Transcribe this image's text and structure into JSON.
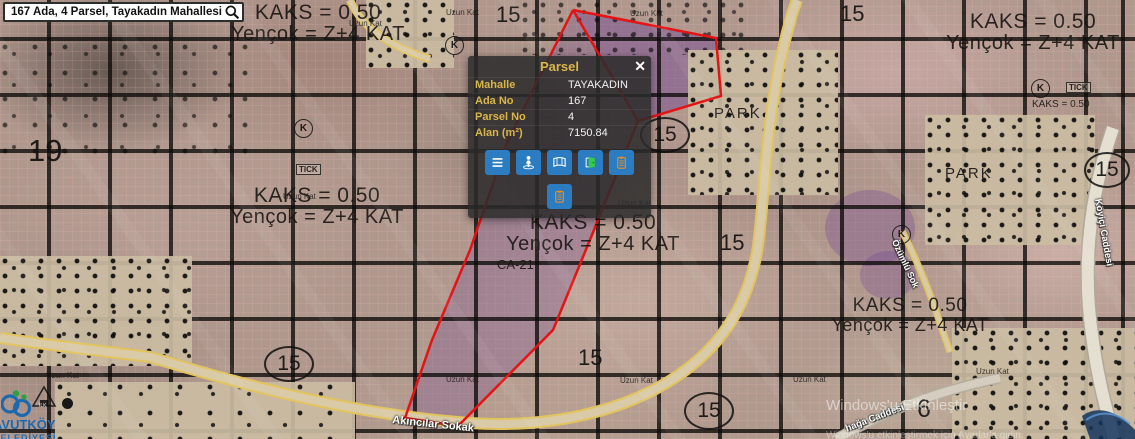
{
  "search": {
    "value": "167 Ada, 4 Parsel, Tayakadın Mahallesi",
    "icon": "magnifier-icon"
  },
  "popup": {
    "title": "Parsel",
    "close_label": "✕",
    "fields": [
      {
        "label": "Mahalle",
        "value": "TAYAKADIN"
      },
      {
        "label": "Ada No",
        "value": "167"
      },
      {
        "label": "Parsel No",
        "value": "4"
      },
      {
        "label": "Alan (m²)",
        "value": "7150.84"
      }
    ],
    "buttons": [
      {
        "icon": "menu-icon"
      },
      {
        "icon": "street-view-icon"
      },
      {
        "icon": "panorama-icon"
      },
      {
        "icon": "door-icon"
      },
      {
        "icon": "clipboard-icon"
      },
      {
        "icon": "clipboard-icon"
      }
    ],
    "colors": {
      "accent_gold": "#d9b64a",
      "button_blue": "#2b7cc0",
      "panel_bg": "rgba(42,42,42,0.85)"
    }
  },
  "map": {
    "zoning": {
      "kaks": "KAKS = 0.50",
      "yencok": "Yençok = Z+4 KAT",
      "tick": "TICK",
      "ca": "CA-21"
    },
    "numbers": {
      "n19": "19",
      "n15": "15",
      "n6": "6",
      "k": "K"
    },
    "park_label": "PARK",
    "uzun_kat": "Uzun Kat",
    "roads": {
      "akincilar": "Akıncılar Sokak",
      "koyici": "Köyiçi Caddesi",
      "ozumlu": "Özümlü Sok",
      "aga": "hağa Caddesi"
    },
    "colors": {
      "parcel_outline": "#e51313",
      "road_yellow": "#e2c45e",
      "selection_purple": "rgba(108,62,148,0.32)"
    }
  },
  "branding": {
    "logo_text": "AVUTKÖY",
    "logo_subtext": "BELEDİYESİ",
    "legend_school": "İLK"
  },
  "system_watermark": {
    "line1": "Windows'u Etkinleştir",
    "line2": "Windows'u etkinleştirmek için Ayarlar'a gidin."
  }
}
